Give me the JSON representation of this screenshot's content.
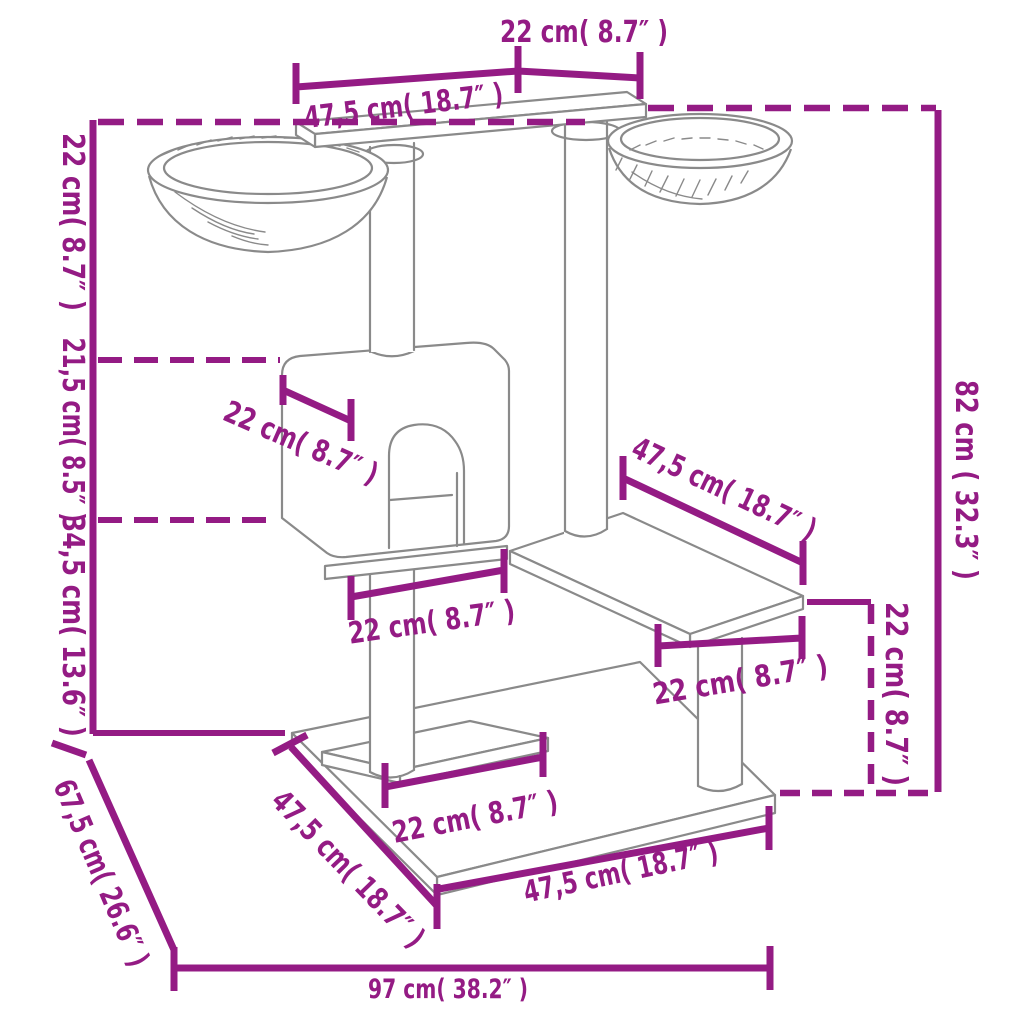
{
  "page": {
    "title": "Cat tree with scratching posts — dimension diagram"
  },
  "style": {
    "annotation_color": "#941B84",
    "drawing_line_color": "#8a8a8a",
    "background_color": "#ffffff"
  },
  "drawing": {
    "parts": [
      "top-platform",
      "left-hanging-bowl",
      "right-hanging-bowl",
      "scratching-posts",
      "cat-house-with-arch-door",
      "middle-platform",
      "right-step-platform",
      "base-inner-platform",
      "base-board"
    ]
  },
  "labels": {
    "top_platform_depth": "22 cm( 8.7″ )",
    "top_platform_length": "47,5 cm( 18.7″ )",
    "left_upper_height": "22 cm( 8.7″ )",
    "left_house_height": "21,5 cm( 8.5″ )",
    "left_lower_height": "34,5 cm( 13.6″ )",
    "house_depth": "22 cm( 8.7″ )",
    "right_platform_length": "47,5 cm( 18.7″ )",
    "mid_platform_width": "22 cm( 8.7″ )",
    "right_platform_post_offset": "22 cm( 8.7″ )",
    "right_step_height": "22 cm( 8.7″ )",
    "total_height": "82 cm ( 32.3″ )",
    "base_diagonal_depth": "67,5 cm( 26.6″ )",
    "base_left_edge": "47,5 cm( 18.7″ )",
    "base_inner_platform_width": "22 cm( 8.7″ )",
    "base_front_edge": "47,5 cm( 18.7″ )",
    "total_width": "97 cm( 38.2″ )"
  }
}
